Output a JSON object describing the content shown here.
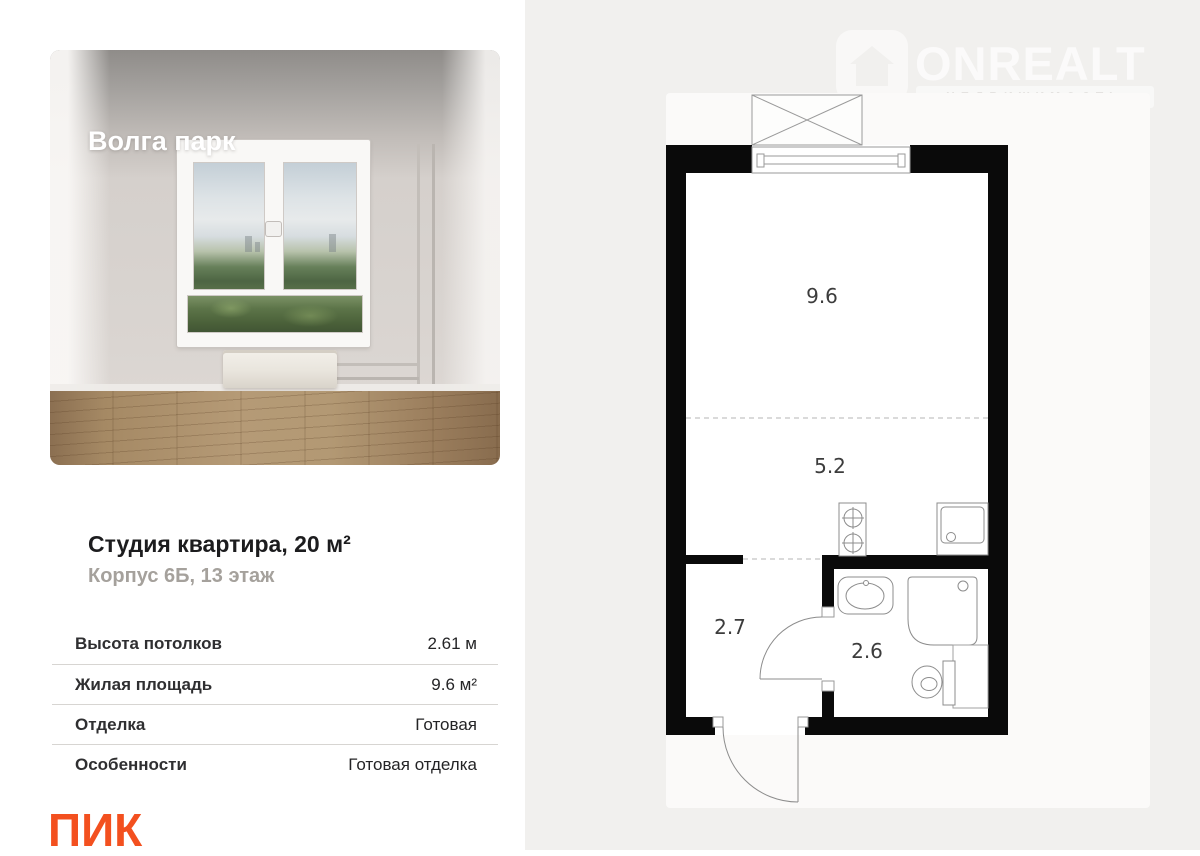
{
  "listing": {
    "project_name": "Волга парк",
    "title": "Студия квартира, 20 м²",
    "subtitle": "Корпус 6Б, 13 этаж",
    "specs": {
      "rows": [
        {
          "label": "Высота потолков",
          "value": "2.61 м"
        },
        {
          "label": "Жилая площадь",
          "value": "9.6 м²"
        },
        {
          "label": "Отделка",
          "value": "Готовая"
        },
        {
          "label": "Особенности",
          "value": "Готовая отделка"
        }
      ]
    },
    "developer_logo_text": "ПИК"
  },
  "watermark": {
    "brand": "ONREALT",
    "tagline": "НЕДВИЖИМОСТЬ",
    "icon": "house-icon"
  },
  "floor_plan": {
    "type": "studio-apartment-plan",
    "rooms": [
      {
        "name": "living-room",
        "area": "9.6"
      },
      {
        "name": "kitchen-zone",
        "area": "5.2"
      },
      {
        "name": "hallway",
        "area": "2.7"
      },
      {
        "name": "bathroom",
        "area": "2.6"
      }
    ],
    "features": [
      "balcony",
      "window",
      "stove",
      "kitchen-sink",
      "wash-basin",
      "shower",
      "toilet",
      "entrance-door",
      "bathroom-door"
    ]
  },
  "colors": {
    "accent_orange": "#f3501f",
    "panel_bg": "#f1f0ee",
    "plan_wall": "#0a0a0a",
    "card_bg": "#fbfaf9"
  }
}
